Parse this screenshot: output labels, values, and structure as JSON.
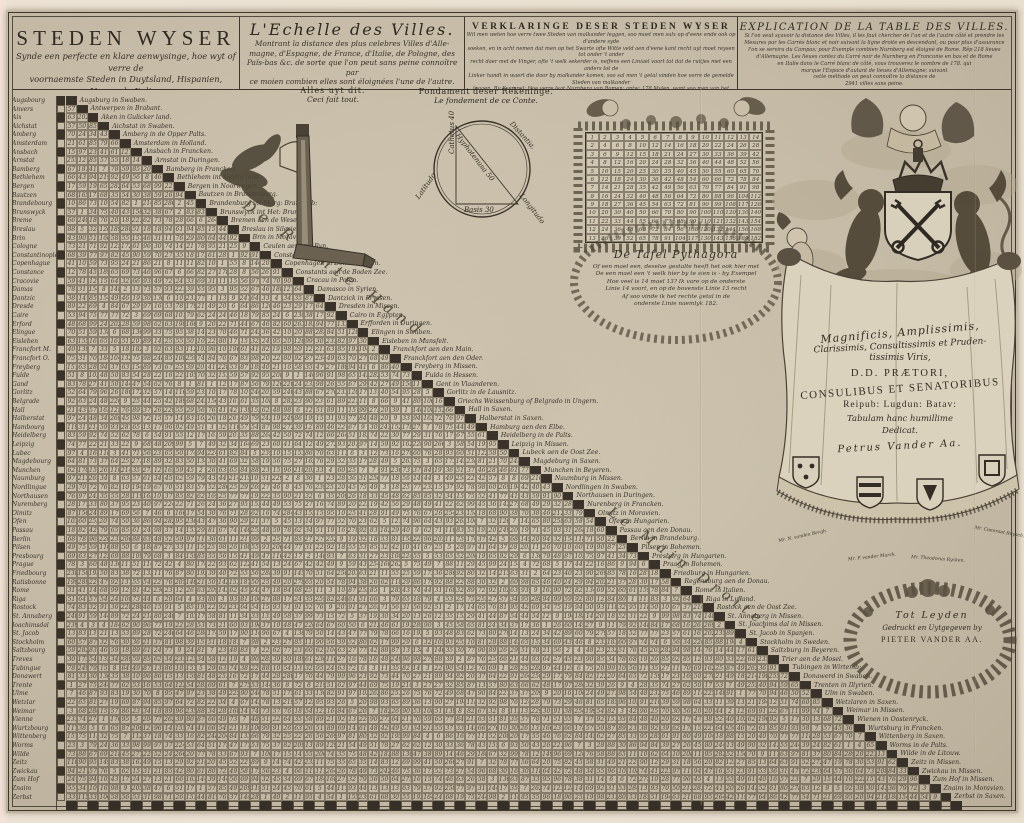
{
  "header": {
    "panel1": {
      "title": "STEDEN WYSER",
      "lines": [
        "Synde een perfecte en klare aenwysinge, hoe wyt of verre de",
        "voornaemste Steden in Duytsland, Hispanien, Vrancryk, Italien",
        "Engeland, Polen, Nederlanden &c. van malkanderen leggen."
      ]
    },
    "panel2": {
      "title": "L'Echelle des Villes.",
      "lines": [
        "Montrant la distance des plus celebres Villes d'Alle-",
        "magne, d'Espagne, de France, d'Italie, de Pologne, des",
        "Païs-bas &c. de sorte que l'on peut sans peine connoître par",
        "ce moien combien elles sont éloignées l'une de l'autre."
      ]
    },
    "panel3": {
      "title": "VERKLARINGE DESER STEDEN WYSER",
      "lines": [
        "Wil men weten hoe verre twee Steden van malkander leggen, soo moet men sulx op d'eene ende ook op d'andere syde",
        "soeken, en in acht nemen dat men op het Swarte ofte Witte veld aen d'eene kant recht uyt moet reysen tot onder 't ander",
        "recht daer met de Vinger, ofte 't welk sekerder is, neffens een Liniael voort tot dat de ruitjes met een anders tot de",
        "Linker handt in waert die door by malkander komen, soo sal men 't getal vinden hoe verre de gemelde Steden van malkander",
        "leggen. By Exempel: Hoe verre legt Nurnberg van Romen: antw: 178 Mylen, want soo men van het swart Vierkant",
        "by Nurnberg in Francken in het swarte veld nederwaert gaet en van het wit Romen in Italien in het witte veld, binnen waer",
        "vindt gy het getal van 178, soodanig kan men op dese manier de distantie van 2941 Steden sonder moeyte bekomen."
      ]
    },
    "panel4": {
      "title": "EXPLICATION DE LA TABLE DES VILLES.",
      "lines": [
        "Si l'on veut sçavoir la distance des Villes, il les faut chercher de l'un et de l'autre côté et prendre les",
        "Mesures par les Carrés blanc et noir suivant la ligne droite en descendant, ou pour plus d'assurance",
        "l'on se servira du Compas; pour Exemple combien Nurnberg est éloigné de Rome. Rêp 218 lieues",
        "d'Allemagne. Les lieues contez du Carré noir de Nurnberg en Franconie en bas et de Rome",
        "en Italie dans le Carré blanc de côté, vous trouverez le nombre de 178. qui",
        "marque l'Espace d'autant de lieues d'Allemagne; suivant",
        "cette méthode on peut connoître la distance de",
        "2941 villes sans peine."
      ]
    }
  },
  "instruments": {
    "square": {
      "label_nl": "Alles uyt dit.",
      "label_fr": "Ceci fait tout."
    },
    "circle": {
      "title_nl": "Fondament deser Rekeninge.",
      "title_fr": "Le fondement de ce Conte.",
      "latitudo": "Latitudo",
      "distantia": "Distantia.",
      "longitudo": "Longitudo",
      "cathetus": "Cathetus 40",
      "basis": "Basis 30",
      "hypotenusa": "Hyphotenusa 50"
    }
  },
  "pythagoras": {
    "rows": 13,
    "cols": 14,
    "title": "De Tafel Pythagora",
    "lines": [
      "Of een mael een, deselve gestalte heeft het ook hier met",
      "De een mael een 't welk hier by te sien is - by Exempel",
      "Hoe veel is 14 mael 13? Ik vare op de onderste",
      "Linie 14 voort, en op de bovenste Linie 13 recht",
      "Af soo vinde ik het rechte getal in de",
      "onderste Linie naemlyk 182."
    ]
  },
  "dedication": {
    "lines": [
      "Magnificis, Amplissimis,",
      "Clarissimis, Consultissimis et Pruden-",
      "tissimis Viris,",
      "D.D. PRÆTORI,",
      "CONSULIBUS ET SENATORIBUS",
      "Reipub: Lugdun: Batav:",
      "Tabulam hanc humillime",
      "Dedicat.",
      "Petrus Vander Aa."
    ],
    "shield_captions": [
      "Mr. N. vanden Bergh.",
      "Mr. P. vander Marck.",
      "Mr. Theodorus Rycken.",
      "Mr. Coenraet Ruysch."
    ]
  },
  "imprint": {
    "line1": "Tot Leyden",
    "line2": "Gedruckt en Uytgegeven by",
    "line3": "PIETER VANDER AA."
  },
  "matrix": {
    "hand_label_nl": "De Rechte Hand.",
    "hand_label_fr": "Le Main Droite.",
    "cell_seed": 11,
    "rows": [
      {
        "left": "Augsbourg",
        "diag": "Augsburg in Swaben."
      },
      {
        "left": "Anvers",
        "diag": "Antwerpen in Brabant."
      },
      {
        "left": "Aix",
        "diag": "Aken in Gulicker land."
      },
      {
        "left": "Aichstat",
        "diag": "Aichstat in Swaben."
      },
      {
        "left": "Amberg",
        "diag": "Amberg in de Opper Palts."
      },
      {
        "left": "Amsterdam",
        "diag": "Amsterdam in Holland."
      },
      {
        "left": "Ansbach",
        "diag": "Ansbach in Francken."
      },
      {
        "left": "Arnstat",
        "diag": "Arnstat in Duringen."
      },
      {
        "left": "Bamberg",
        "diag": "Bamberg in Francken."
      },
      {
        "left": "Bethlehem",
        "diag": "Bethlehem int Heylig land."
      },
      {
        "left": "Bergen",
        "diag": "Bergen in Noorwegen."
      },
      {
        "left": "Bautzen",
        "diag": "Bautzen in Brandenburg."
      },
      {
        "left": "Brandebourg",
        "diag": "Brandenburg int Marg: Brandenb:"
      },
      {
        "left": "Brunswyck",
        "diag": "Brunswyck int Het: Brunsw:"
      },
      {
        "left": "Breme",
        "diag": "Bremen aen de Weser."
      },
      {
        "left": "Breslau",
        "diag": "Breslau in Silesien."
      },
      {
        "left": "Brin",
        "diag": "Brin in Moravien."
      },
      {
        "left": "Cologne",
        "diag": "Ceulen aen den Ryn."
      },
      {
        "left": "Constantinople",
        "diag": "Constantinopolen in Thra:"
      },
      {
        "left": "Copenhague",
        "diag": "Copenhagen in Dennemarken."
      },
      {
        "left": "Constance",
        "diag": "Constants aen de Boden Zee."
      },
      {
        "left": "Cracovie",
        "diag": "Cracau in Polen."
      },
      {
        "left": "Damas",
        "diag": "Damasco in Syrien."
      },
      {
        "left": "Dantzic",
        "diag": "Dantzick in Pryssen."
      },
      {
        "left": "Dresde",
        "diag": "Dresden in Missen."
      },
      {
        "left": "Caire",
        "diag": "Cairo in Egypten."
      },
      {
        "left": "Erford",
        "diag": "Erfforden in Duringen."
      },
      {
        "left": "Elingue",
        "diag": "Elingen in Swaben."
      },
      {
        "left": "Eisleben",
        "diag": "Eisleben in Mansfelt."
      },
      {
        "left": "Francfort M.",
        "diag": "Franckfort aen den Main."
      },
      {
        "left": "Francfort O.",
        "diag": "Franckfort aen den Oder."
      },
      {
        "left": "Freyberg",
        "diag": "Freyberg in Missen."
      },
      {
        "left": "Fulde",
        "diag": "Fulda in Hessen."
      },
      {
        "left": "Gand",
        "diag": "Gent in Vlaanderen."
      },
      {
        "left": "Gorlitz",
        "diag": "Gorlitz in de Lausnitz."
      },
      {
        "left": "Belgrade",
        "diag": "Griechs Weissenburg of Belgrado in Ungern."
      },
      {
        "left": "Hall",
        "diag": "Hall in Saxen."
      },
      {
        "left": "Halberstat",
        "diag": "Halberstat in Saxen."
      },
      {
        "left": "Hambourg",
        "diag": "Hamburg aen den Elbe."
      },
      {
        "left": "Heidelberg",
        "diag": "Heidelberg in de Palts."
      },
      {
        "left": "Leipzig",
        "diag": "Leipzig in Missen."
      },
      {
        "left": "Lubec",
        "diag": "Lubeck aen de Oost Zee."
      },
      {
        "left": "Magdebourg",
        "diag": "Magdeburg in Saxen."
      },
      {
        "left": "Munchen",
        "diag": "Munchen in Beyeren."
      },
      {
        "left": "Naumburg",
        "diag": "Naumburg in Missen."
      },
      {
        "left": "Nordlingue",
        "diag": "Nordlingen in Swaben."
      },
      {
        "left": "Northausen",
        "diag": "Northausen in Duringen."
      },
      {
        "left": "Nuremberg",
        "diag": "Nurenberg in Francken."
      },
      {
        "left": "Olmitz",
        "diag": "Olmitz in Moravien."
      },
      {
        "left": "Ofen",
        "diag": "Ofen in Hungarien."
      },
      {
        "left": "Passau",
        "diag": "Passau aen den Donau."
      },
      {
        "left": "Berlin",
        "diag": "Berlin in Brandeburg."
      },
      {
        "left": "Pilsen",
        "diag": "Pilsen in Bohemen."
      },
      {
        "left": "Presbourg",
        "diag": "Presburg in Hungarien."
      },
      {
        "left": "Prague",
        "diag": "Praag in Bohemen."
      },
      {
        "left": "Friedbourg",
        "diag": "Friedburg in Hungarien."
      },
      {
        "left": "Ratisbonne",
        "diag": "Regensburg aen de Donau."
      },
      {
        "left": "Rome",
        "diag": "Rome in Italien."
      },
      {
        "left": "Riga",
        "diag": "Riga in Lyfland."
      },
      {
        "left": "Rostock",
        "diag": "Rostock aen de Oost Zee."
      },
      {
        "left": "St. Annaberg",
        "diag": "St. Annaberg in Missen."
      },
      {
        "left": "Joachimsdal",
        "diag": "St. Joachims dal in Missen."
      },
      {
        "left": "St. Jacob",
        "diag": "St. Jacob in Spanjen."
      },
      {
        "left": "Stockholm",
        "diag": "Stockholm in Sweden."
      },
      {
        "left": "Saltzbourg",
        "diag": "Saltzburg in Beyeren."
      },
      {
        "left": "Treves",
        "diag": "Trier aen de Mosel."
      },
      {
        "left": "Tubingue",
        "diag": "Tubingen in Wirtemb:"
      },
      {
        "left": "Donawert",
        "diag": "Donawerd in Swaben."
      },
      {
        "left": "Trente",
        "diag": "Trenten in Illyrien."
      },
      {
        "left": "Ulme",
        "diag": "Ulm in Swaben."
      },
      {
        "left": "Wetzlar",
        "diag": "Wetzlaren in Saxen."
      },
      {
        "left": "Weimar",
        "diag": "Weimar in Missen."
      },
      {
        "left": "Vienne",
        "diag": "Wienen in Oostenryck."
      },
      {
        "left": "Wurtzbourg",
        "diag": "Wurtsburg in Francken."
      },
      {
        "left": "Wittenberg",
        "diag": "Wittenberg in Saxen."
      },
      {
        "left": "Worms",
        "diag": "Worms in de Palts."
      },
      {
        "left": "Wilde",
        "diag": "Wilde in de Litouw."
      },
      {
        "left": "Zeitz",
        "diag": "Zeitz in Missen."
      },
      {
        "left": "Zwickau",
        "diag": "Zwickau in Missen."
      },
      {
        "left": "Zum Hof",
        "diag": "Zum Hof in Missen."
      },
      {
        "left": "Znaim",
        "diag": "Znaim in Moravien."
      },
      {
        "left": "Zerbst",
        "diag": "Zerbst in Saxen."
      }
    ]
  }
}
